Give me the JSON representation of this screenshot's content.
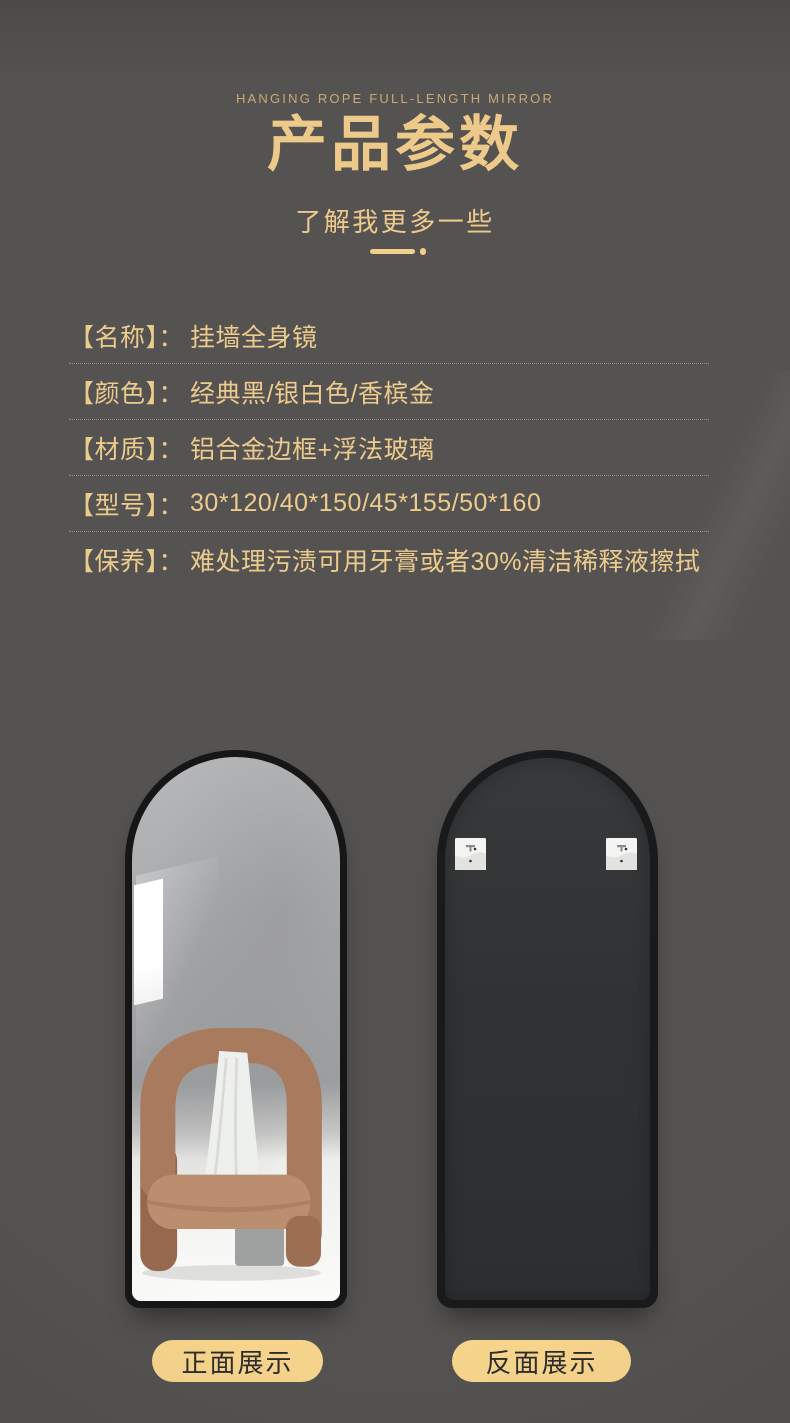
{
  "theme": {
    "background": "#555351",
    "gold": "#eeca8a",
    "gold_dim": "#c9aa74",
    "pill_bg": "#f8d68d",
    "pill_text": "#2d2d2d",
    "frame_black": "#161616",
    "back_panel": "#313335"
  },
  "header": {
    "eyebrow": "HANGING ROPE FULL-LENGTH MIRROR",
    "title": "产品参数",
    "subtitle": "了解我更多一些"
  },
  "specs": [
    {
      "label": "【名称】：",
      "value": "挂墙全身镜"
    },
    {
      "label": "【颜色】：",
      "value": "经典黑/银白色/香槟金"
    },
    {
      "label": "【材质】：",
      "value": "铝合金边框+浮法玻璃"
    },
    {
      "label": "【型号】：",
      "value": "30*120/40*150/45*155/50*160"
    },
    {
      "label": "【保养】：",
      "value": "难处理污渍可用牙膏或者30%清洁稀释液擦拭"
    }
  ],
  "captions": {
    "front": "正面展示",
    "back": "反面展示"
  }
}
